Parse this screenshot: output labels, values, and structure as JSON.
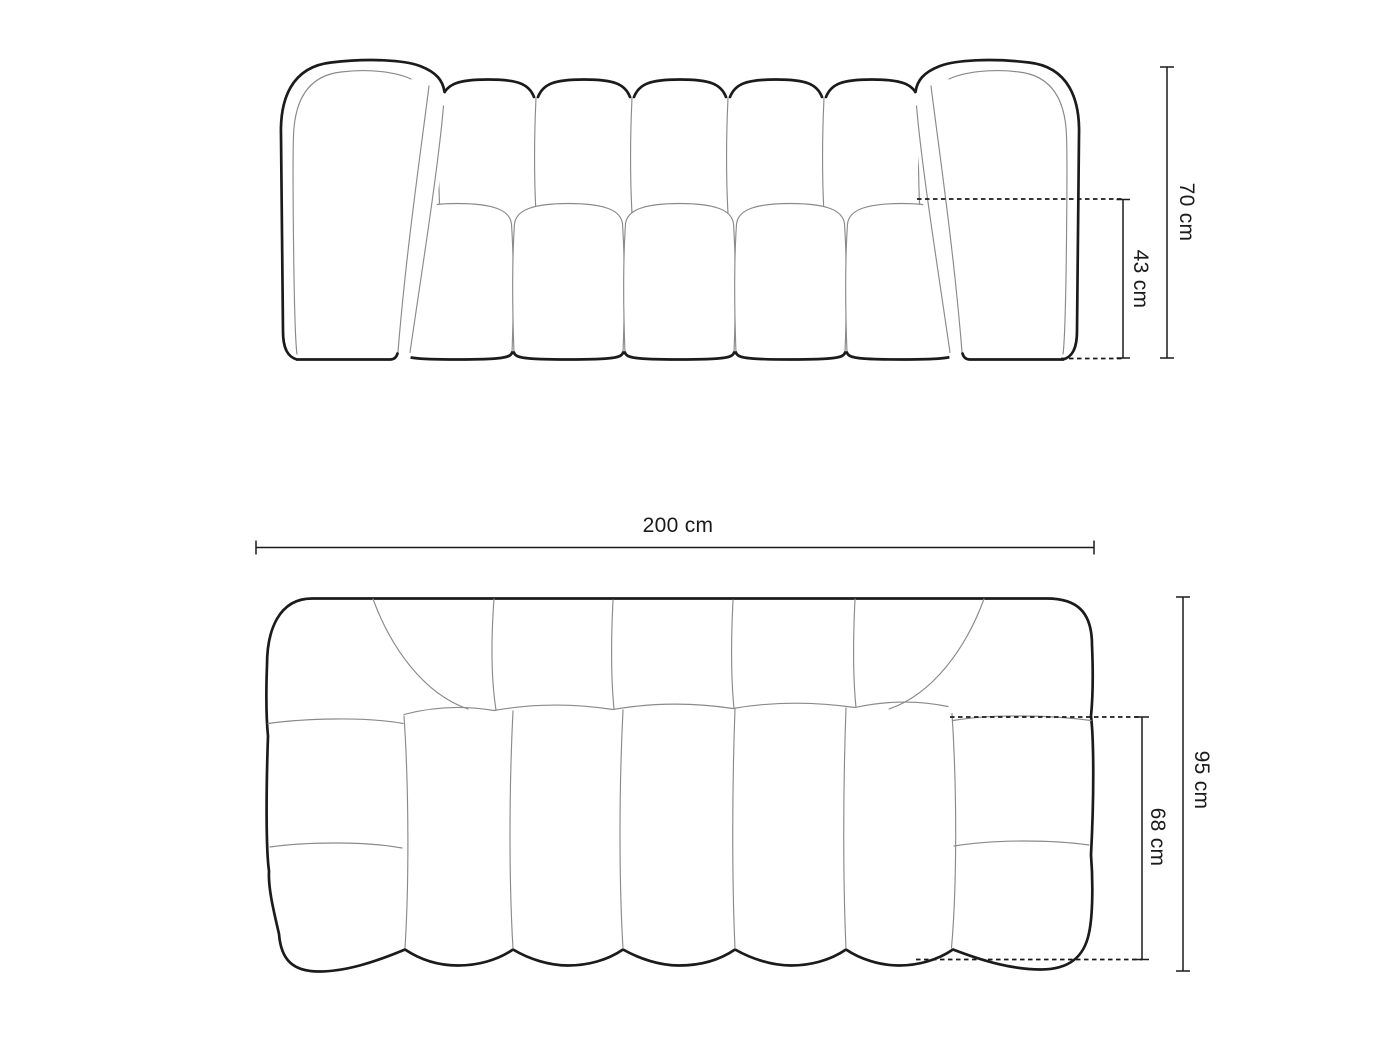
{
  "page": {
    "background_color": "#ffffff"
  },
  "diagram": {
    "type": "furniture-dimension-drawing",
    "subject": "tufted modular sofa, line drawing with dimensions",
    "units": "cm",
    "style": {
      "outline_color": "#1b1b1b",
      "seam_color": "#8a8a8a",
      "dimension_line_color": "#1b1b1b",
      "text_color": "#1b1b1b",
      "background": "#ffffff"
    },
    "views": {
      "front": {
        "name": "front elevation",
        "dimensions": {
          "total_height": {
            "label": "70 cm",
            "value": 70,
            "unit": "cm",
            "orientation": "vertical",
            "measures": "overall height"
          },
          "seat_height": {
            "label": "43 cm",
            "value": 43,
            "unit": "cm",
            "orientation": "vertical",
            "measures": "seat height"
          }
        }
      },
      "top": {
        "name": "top plan",
        "dimensions": {
          "total_width": {
            "label": "200 cm",
            "value": 200,
            "unit": "cm",
            "orientation": "horizontal",
            "measures": "overall width"
          },
          "total_depth": {
            "label": "95 cm",
            "value": 95,
            "unit": "cm",
            "orientation": "vertical",
            "measures": "overall depth"
          },
          "seat_depth": {
            "label": "68 cm",
            "value": 68,
            "unit": "cm",
            "orientation": "vertical",
            "measures": "seat depth"
          }
        }
      }
    }
  }
}
